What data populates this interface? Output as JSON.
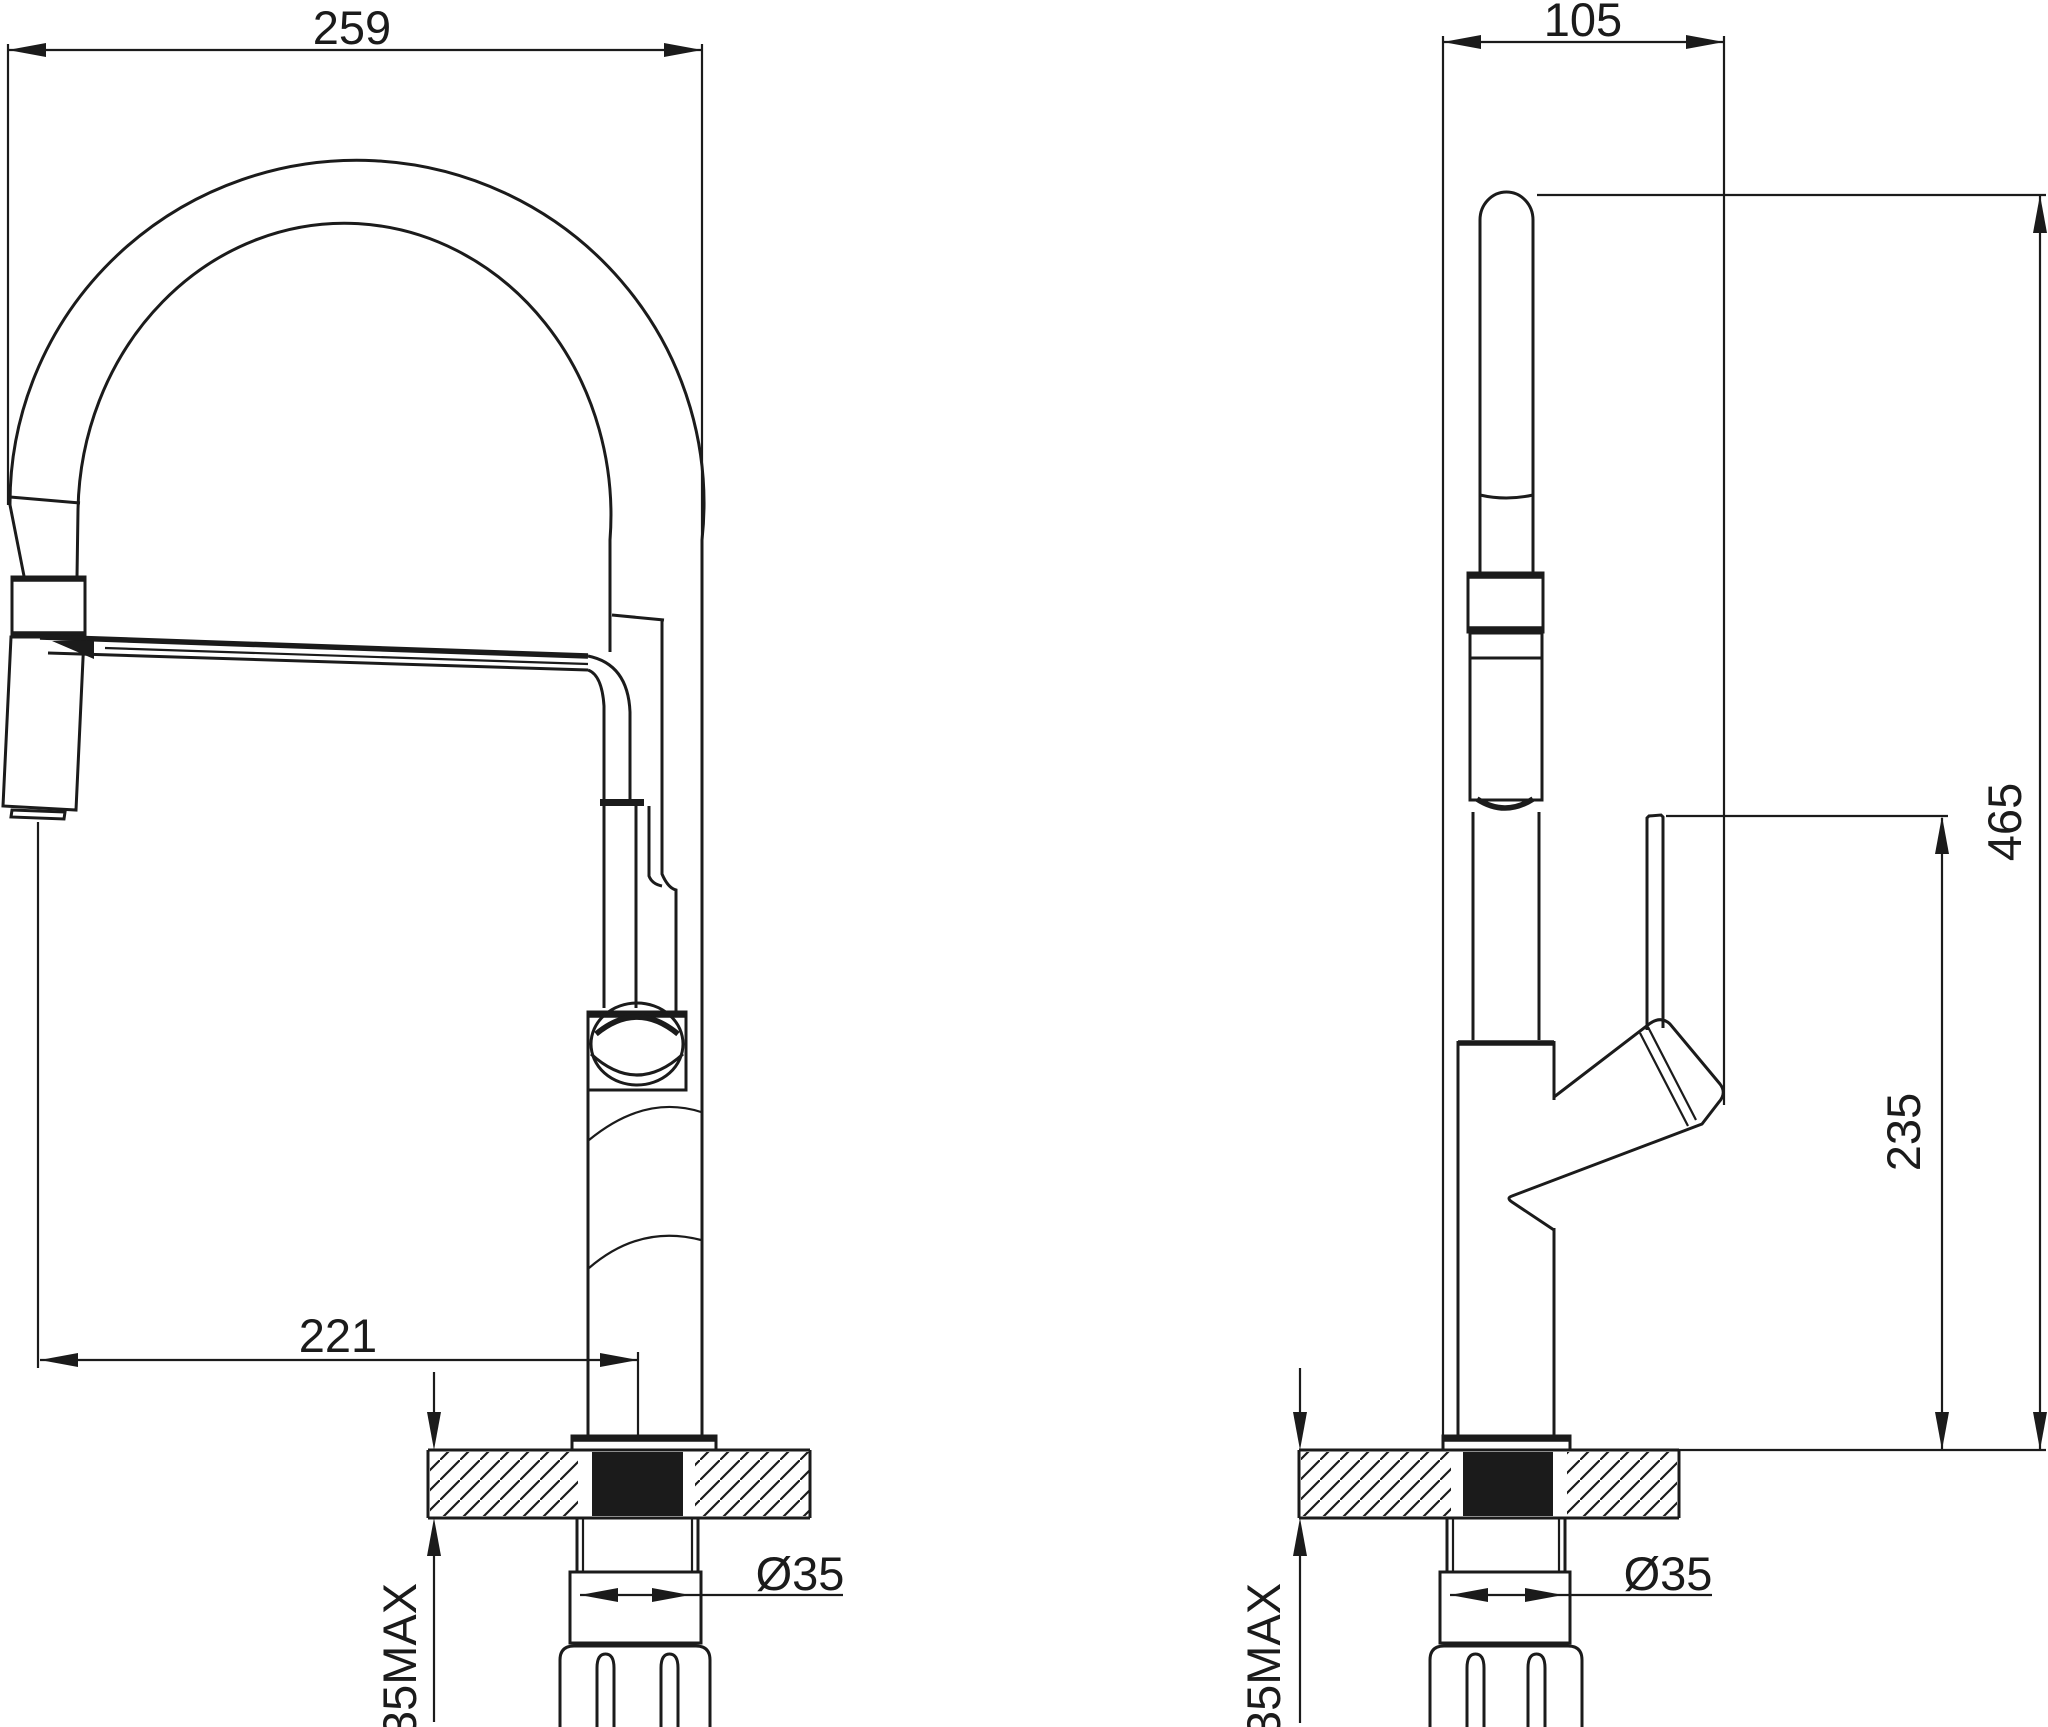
{
  "colors": {
    "ink": "#1b1b1b",
    "background": "#ffffff"
  },
  "views": {
    "front": {
      "dims": {
        "overall_width": "259",
        "spout_reach": "221",
        "mounting_hole_diameter": "Ø35",
        "max_deck_thickness": "35MAX"
      }
    },
    "side": {
      "dims": {
        "overall_depth": "105",
        "overall_height": "465",
        "handle_height": "235",
        "mounting_hole_diameter": "Ø35",
        "max_deck_thickness": "35MAX"
      }
    }
  }
}
